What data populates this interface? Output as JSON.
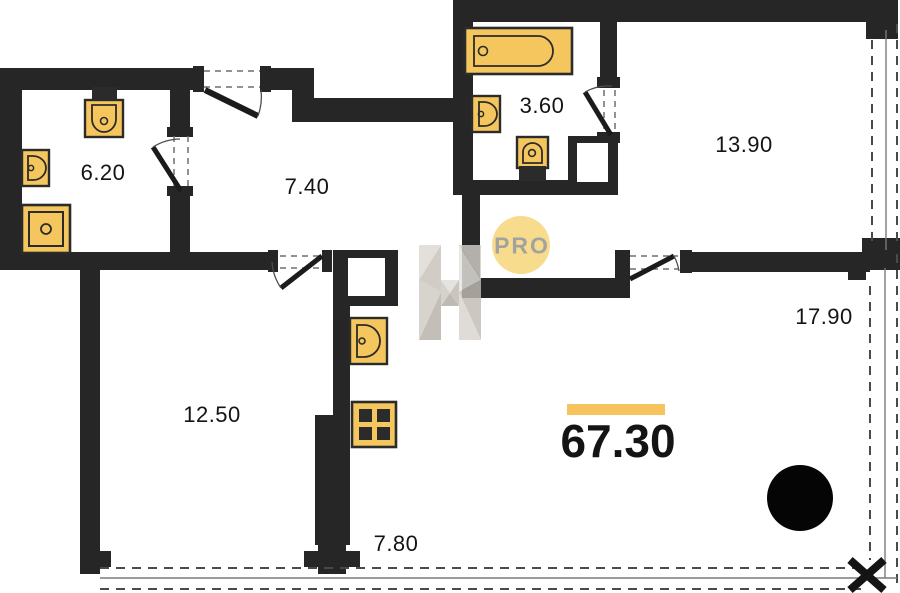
{
  "plan": {
    "total_area": "67.30",
    "rooms": [
      {
        "name": "bathroom-small",
        "area": "6.20"
      },
      {
        "name": "hallway",
        "area": "7.40"
      },
      {
        "name": "bathroom",
        "area": "3.60"
      },
      {
        "name": "bedroom",
        "area": "13.90"
      },
      {
        "name": "living-room",
        "area": "17.90"
      },
      {
        "name": "bedroom-2",
        "area": "12.50"
      },
      {
        "name": "kitchen",
        "area": "7.80"
      }
    ],
    "watermark": {
      "logo_text": "PRO"
    },
    "icons": [
      "bathtub-icon",
      "toilet-icon",
      "sink-icon",
      "shower-icon",
      "kitchen-sink-icon",
      "kitchen-stove-icon",
      "column-circle-icon",
      "pro-logo",
      "h-watermark"
    ],
    "colors": {
      "wall": "#262626",
      "fixture_fill": "#f5c65e",
      "accent_bar": "#f6c45c",
      "logo_circle": "#f8dc8e",
      "logo_text": "#a2a29e",
      "background": "#ffffff"
    }
  }
}
